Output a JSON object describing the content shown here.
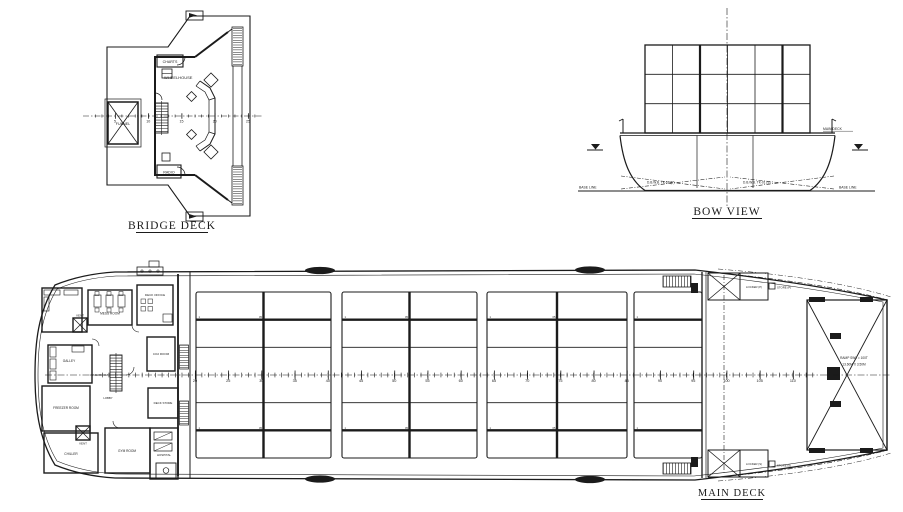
{
  "page": {
    "background": "#ffffff",
    "ink": "#1b1b1b"
  },
  "bridge_deck": {
    "title": "BRIDGE DECK",
    "wheelhouse_label": "WHEELHOUSE",
    "charts_label": "CHARTS",
    "radio_label": "RADIO",
    "funnel_label": "FUNNEL",
    "frame_scale": [
      "5",
      "10",
      "15",
      "20",
      "25"
    ]
  },
  "bow_view": {
    "title": "BOW VIEW",
    "main_deck_label": "MAIN DECK",
    "base_line_left": "BASE LINE",
    "base_line_right": "BASE LINE",
    "tank_port": "D.B.W.B. TK-01 (P)",
    "tank_stbd": "D.B.W.B. TK-01 (S)",
    "container_grid": {
      "columns": 6,
      "rows": 3
    }
  },
  "main_deck": {
    "title": "MAIN DECK",
    "rooms": {
      "mess_room": "MESS ROOM",
      "deck_office": "DECK OFFICE",
      "co2_room": "CO2 ROOM",
      "vent_fwd": "VENT",
      "vent_aft": "VENT",
      "galley": "GALLEY",
      "wash_room": "WASH ROOM",
      "lobby": "LOBBY",
      "freezer_room": "FREEZER ROOM",
      "chiller": "CHILLER",
      "gym_room": "GYM ROOM",
      "hospital": "HOSPITAL",
      "deck_store": "DECK STORE"
    },
    "bow_area": {
      "locker_p": "LOCKER (P)",
      "store_p": "STORE (P)",
      "locker_s": "LOCKER (S)",
      "store_s": "STORE (S)",
      "ramp_line1": "RAMP SWL = 100T",
      "ramp_line2": "13.60M X 3.50M"
    },
    "bay_marks": {
      "edge": "1",
      "center": "05"
    },
    "frame_numbers": [
      "20",
      "25",
      "30",
      "35",
      "40",
      "45",
      "50",
      "55",
      "60",
      "65",
      "70",
      "75",
      "80",
      "85",
      "90",
      "95",
      "100",
      "105",
      "110"
    ]
  }
}
